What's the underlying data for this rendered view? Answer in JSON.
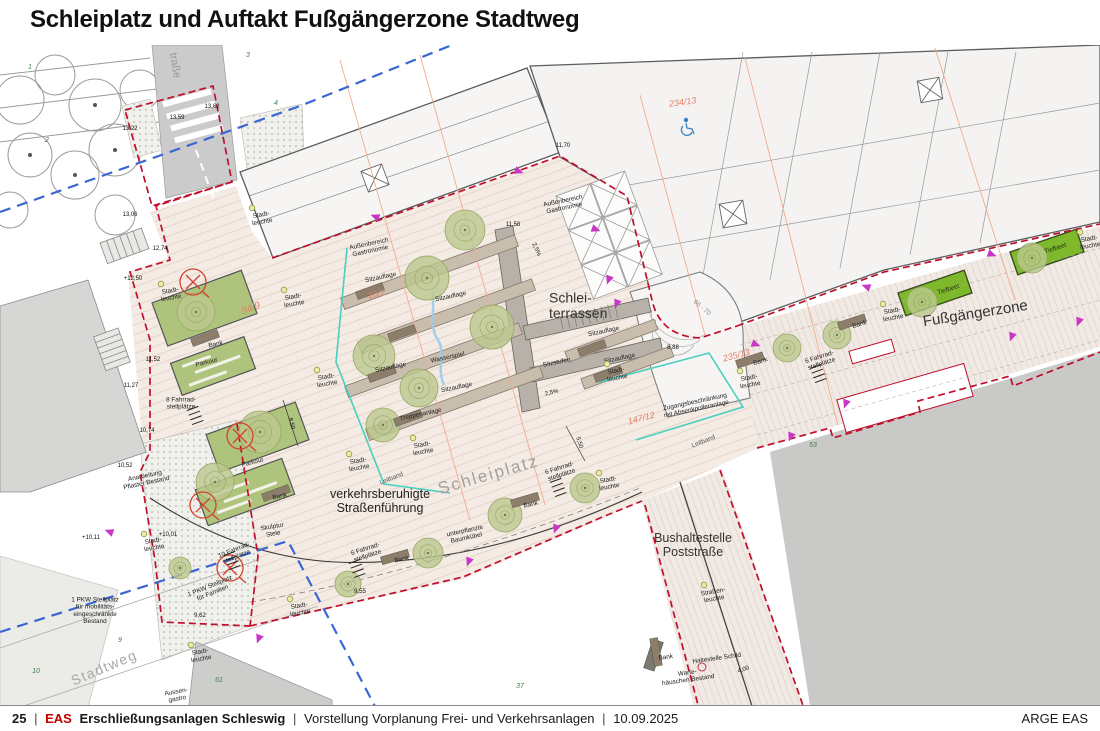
{
  "slide": {
    "title": "Schleiplatz und Auftakt Fußgängerzone Stadtweg",
    "footer": {
      "page": "25",
      "sep": "|",
      "brand": "EAS",
      "project": "Erschließungsanlagen Schleswig",
      "subtitle": "Vorstellung Vorplanung Frei- und Verkehrsanlagen",
      "date": "10.09.2025",
      "right": "ARGE EAS"
    }
  },
  "colors": {
    "paving": "#f3ebe4",
    "paving_stripe": "#e0cabb",
    "boundary_red": "#c00f2d",
    "line_blue": "#3a66d4",
    "line_cyan": "#49cfc0",
    "line_salmon": "#f2ab90",
    "tiefbeet_green": "#7db92a",
    "bed_green": "#aec47c",
    "tree_green": "#bcc88f",
    "bench_brown": "#8d7e6b",
    "existing_gray": "#c9c9c7",
    "parcel_red": "#e28266",
    "arrow_magenta": "#c738c7"
  },
  "plan": {
    "labels": [
      {
        "t": "Schlei-\nterrassen",
        "x": 549,
        "y": 310,
        "s": 14,
        "a": "start",
        "c": "#333"
      },
      {
        "t": "Fußgängerzone",
        "x": 976,
        "y": 318,
        "s": 15,
        "r": -9,
        "c": "#333"
      },
      {
        "t": "Schleiplatz",
        "x": 490,
        "y": 480,
        "s": 17,
        "r": -16,
        "c": "#a3a09d",
        "ls": 2
      },
      {
        "t": "verkehrsberuhigte\nStraßenführung",
        "x": 380,
        "y": 505,
        "s": 12.5,
        "c": "#222"
      },
      {
        "t": "Bushaltestelle\nPoststraße",
        "x": 693,
        "y": 549,
        "s": 12.5,
        "c": "#333"
      },
      {
        "t": "Stadtweg",
        "x": 106,
        "y": 672,
        "s": 14,
        "r": -23,
        "c": "#a8a8a8",
        "ls": 1.5
      },
      {
        "t": "traße",
        "x": 172,
        "y": 66,
        "s": 11,
        "r": 80,
        "c": "#9a9a9a"
      },
      {
        "t": "Außenbereich\nGastronomie",
        "x": 370,
        "y": 249,
        "r": -12
      },
      {
        "t": "Außenbereich\nGastronomie",
        "x": 564,
        "y": 206,
        "r": -12
      },
      {
        "t": "Sitzauflage",
        "x": 381,
        "y": 279,
        "r": -12
      },
      {
        "t": "Sitzauflage",
        "x": 451,
        "y": 298,
        "r": -12
      },
      {
        "t": "Sitzauflage",
        "x": 391,
        "y": 369,
        "r": -12
      },
      {
        "t": "Sitzauflage",
        "x": 457,
        "y": 389,
        "r": -12
      },
      {
        "t": "Sitzauflage",
        "x": 604,
        "y": 333,
        "r": -12
      },
      {
        "t": "Sitzauflage",
        "x": 620,
        "y": 360,
        "r": -12
      },
      {
        "t": "Wasserspiel",
        "x": 448,
        "y": 359,
        "r": -12
      },
      {
        "t": "Treppenanlage",
        "x": 421,
        "y": 416,
        "r": -12
      },
      {
        "t": "Sitzstufen",
        "x": 557,
        "y": 364,
        "r": -12
      },
      {
        "t": "Leitband",
        "x": 392,
        "y": 480,
        "r": -22,
        "c": "#555"
      },
      {
        "t": "Leitband",
        "x": 704,
        "y": 443,
        "r": -22,
        "c": "#555"
      },
      {
        "t": "Stadt-\nleuchte",
        "x": 171,
        "y": 296,
        "r": -10
      },
      {
        "t": "Stadt-\nleuchte",
        "x": 294,
        "y": 302,
        "r": -10
      },
      {
        "t": "Stadt-\nleuchte",
        "x": 327,
        "y": 382,
        "r": -10
      },
      {
        "t": "Stadt-\nleuchte",
        "x": 359,
        "y": 466,
        "r": -10
      },
      {
        "t": "Stadt-\nleuchte",
        "x": 423,
        "y": 450,
        "r": -10
      },
      {
        "t": "Stadt-\nleuchte",
        "x": 617,
        "y": 376,
        "r": -10
      },
      {
        "t": "Stadt-\nleuchte",
        "x": 609,
        "y": 485,
        "r": -10
      },
      {
        "t": "Stadt-\nleuchte",
        "x": 750,
        "y": 383,
        "r": -10
      },
      {
        "t": "Stadt-\nleuchte",
        "x": 893,
        "y": 316,
        "r": -10
      },
      {
        "t": "Stadt-\nleuchte",
        "x": 1090,
        "y": 244,
        "r": -10
      },
      {
        "t": "Stadt-\nleuchte",
        "x": 154,
        "y": 546,
        "r": -10
      },
      {
        "t": "Stadt-\nleuchte",
        "x": 201,
        "y": 657,
        "r": -10
      },
      {
        "t": "Stadt-\nleuchte",
        "x": 300,
        "y": 611,
        "r": -10
      },
      {
        "t": "Stadt-\nleuchte",
        "x": 262,
        "y": 220,
        "r": -10
      },
      {
        "t": "Straßen-\nleuchte",
        "x": 714,
        "y": 597,
        "r": -10
      },
      {
        "t": "Bank",
        "x": 216,
        "y": 346,
        "r": -12
      },
      {
        "t": "Bank",
        "x": 280,
        "y": 498,
        "r": -12
      },
      {
        "t": "Bank",
        "x": 531,
        "y": 506,
        "r": -12
      },
      {
        "t": "Bank",
        "x": 402,
        "y": 561,
        "r": -12
      },
      {
        "t": "Bank",
        "x": 860,
        "y": 326,
        "r": -18
      },
      {
        "t": "Bank",
        "x": 761,
        "y": 363,
        "r": -18
      },
      {
        "t": "Bank",
        "x": 666,
        "y": 659,
        "r": -8
      },
      {
        "t": "Parkour",
        "x": 207,
        "y": 364,
        "r": -14
      },
      {
        "t": "Parkour",
        "x": 253,
        "y": 464,
        "r": -14
      },
      {
        "t": "8 Fahrrad-\nstellplätze",
        "x": 181,
        "y": 405
      },
      {
        "t": "10 Fahrrad-\nstellplätze",
        "x": 236,
        "y": 555,
        "r": -22
      },
      {
        "t": "6 Fahrrad-\nstellplätze",
        "x": 561,
        "y": 473,
        "r": -18
      },
      {
        "t": "6 Fahrrad-\nstellplätze",
        "x": 367,
        "y": 554,
        "r": -18
      },
      {
        "t": "6 Fahrrad-\nstellplätze",
        "x": 821,
        "y": 362,
        "r": -18
      },
      {
        "t": "Tiefbeet",
        "x": 949,
        "y": 291,
        "r": -18,
        "c": "#1d2d10"
      },
      {
        "t": "Tiefbeet",
        "x": 1056,
        "y": 250,
        "r": -18,
        "c": "#1d2d10"
      },
      {
        "t": "unterpflanzte\nBaumkübel",
        "x": 466,
        "y": 536,
        "r": -12
      },
      {
        "t": "Zugangsbeschränkung\nmit Absenkpolleranlage",
        "x": 696,
        "y": 407,
        "r": -12
      },
      {
        "t": "Anarbeitung\nPflaster Bestand",
        "x": 146,
        "y": 481,
        "r": -12
      },
      {
        "t": "1 PKW Stellplatz\nfür mobilitäts-\neingeschränkte\nBestand",
        "x": 95,
        "y": 612
      },
      {
        "t": "1 PKW Stellplatz\nfür Familien",
        "x": 212,
        "y": 591,
        "r": -22
      },
      {
        "t": "Skulptur\nStele",
        "x": 273,
        "y": 532,
        "r": -10
      },
      {
        "t": "Haltestelle Schild",
        "x": 717,
        "y": 660,
        "r": -8
      },
      {
        "t": "Warte-\nhäuschen Bestand",
        "x": 688,
        "y": 678,
        "r": -8
      },
      {
        "t": "Aussen-\ngastro",
        "x": 177,
        "y": 697,
        "r": -10
      },
      {
        "t": "234/13",
        "x": 683,
        "y": 105,
        "s": 9,
        "r": -8,
        "c": "#e28266",
        "i": true
      },
      {
        "t": "94/9",
        "x": 252,
        "y": 311,
        "s": 10,
        "r": -22,
        "c": "#e28266",
        "i": true
      },
      {
        "t": "10/2",
        "x": 377,
        "y": 297,
        "s": 9,
        "r": -12,
        "c": "#e28266",
        "i": true
      },
      {
        "t": "147/12",
        "x": 642,
        "y": 421,
        "s": 9,
        "r": -15,
        "c": "#e28266",
        "i": true
      },
      {
        "t": "235/13",
        "x": 737,
        "y": 358,
        "s": 9,
        "r": -15,
        "c": "#e28266",
        "i": true
      },
      {
        "t": "66 - 70",
        "x": 701,
        "y": 309,
        "s": 6.5,
        "r": 40,
        "c": "#8a8a8a"
      },
      {
        "t": "13,62",
        "x": 212,
        "y": 108,
        "s": 6,
        "c": "#111"
      },
      {
        "t": "13,59",
        "x": 177,
        "y": 119,
        "s": 6,
        "c": "#111"
      },
      {
        "t": "13,22",
        "x": 130,
        "y": 130,
        "s": 6,
        "c": "#111"
      },
      {
        "t": "13,06",
        "x": 130,
        "y": 216,
        "s": 6,
        "c": "#111"
      },
      {
        "t": "12,74",
        "x": 160,
        "y": 250,
        "s": 6,
        "c": "#111"
      },
      {
        "t": "+12,50",
        "x": 133,
        "y": 280,
        "s": 6,
        "c": "#111"
      },
      {
        "t": "11,70",
        "x": 563,
        "y": 147,
        "s": 6,
        "c": "#111"
      },
      {
        "t": "11,58",
        "x": 513,
        "y": 226,
        "s": 6,
        "c": "#111"
      },
      {
        "t": "11,52",
        "x": 153,
        "y": 361,
        "s": 6,
        "c": "#111"
      },
      {
        "t": "11,27",
        "x": 131,
        "y": 387,
        "s": 6,
        "c": "#111"
      },
      {
        "t": "10,74",
        "x": 147,
        "y": 432,
        "s": 6,
        "c": "#111"
      },
      {
        "t": "10,52",
        "x": 125,
        "y": 467,
        "s": 6,
        "c": "#111"
      },
      {
        "t": "+10,11",
        "x": 91,
        "y": 539,
        "s": 6,
        "c": "#111"
      },
      {
        "t": "+10,01",
        "x": 168,
        "y": 536,
        "s": 6,
        "c": "#111"
      },
      {
        "t": "9,62",
        "x": 200,
        "y": 617,
        "s": 6,
        "c": "#111"
      },
      {
        "t": "9,55",
        "x": 360,
        "y": 593,
        "s": 6,
        "c": "#111"
      },
      {
        "t": "8,88",
        "x": 673,
        "y": 349,
        "s": 6,
        "c": "#111"
      },
      {
        "t": "8,50",
        "x": 290,
        "y": 424,
        "s": 6,
        "r": 75,
        "c": "#111"
      },
      {
        "t": "5,50",
        "x": 578,
        "y": 443,
        "s": 6,
        "r": 72,
        "c": "#111"
      },
      {
        "t": "4,00",
        "x": 744,
        "y": 671,
        "s": 6,
        "r": -20,
        "c": "#111"
      },
      {
        "t": "2,5%",
        "x": 535,
        "y": 250,
        "s": 6,
        "r": 65,
        "c": "#111"
      },
      {
        "t": "2,5%",
        "x": 552,
        "y": 394,
        "s": 6,
        "r": -14,
        "c": "#111"
      },
      {
        "t": "1",
        "x": 30,
        "y": 69,
        "s": 7,
        "c": "#3f7d46",
        "i": true
      },
      {
        "t": "2",
        "x": 47,
        "y": 142,
        "s": 7,
        "c": "#3f7d46",
        "i": true
      },
      {
        "t": "3",
        "x": 248,
        "y": 57,
        "s": 7,
        "c": "#3f7d46",
        "i": true
      },
      {
        "t": "4",
        "x": 276,
        "y": 105,
        "s": 7,
        "c": "#3f7d46",
        "i": true
      },
      {
        "t": "9",
        "x": 120,
        "y": 642,
        "s": 7,
        "c": "#3f7d46",
        "i": true
      },
      {
        "t": "10",
        "x": 36,
        "y": 673,
        "s": 7,
        "c": "#3f7d46",
        "i": true
      },
      {
        "t": "37",
        "x": 520,
        "y": 688,
        "s": 7,
        "c": "#3f7d46",
        "i": true
      },
      {
        "t": "53",
        "x": 813,
        "y": 447,
        "s": 7,
        "c": "#3f7d46",
        "i": true
      },
      {
        "t": "61",
        "x": 219,
        "y": 682,
        "s": 7,
        "c": "#3f7d46",
        "i": true
      }
    ],
    "symbols": {
      "trees": [
        [
          465,
          230,
          20
        ],
        [
          427,
          278,
          22
        ],
        [
          492,
          327,
          22
        ],
        [
          374,
          356,
          21
        ],
        [
          419,
          388,
          19
        ],
        [
          383,
          425,
          17
        ],
        [
          505,
          515,
          17
        ],
        [
          585,
          488,
          15
        ],
        [
          428,
          553,
          15
        ],
        [
          348,
          584,
          13
        ],
        [
          180,
          568,
          11
        ],
        [
          787,
          348,
          14
        ],
        [
          837,
          335,
          14
        ],
        [
          922,
          302,
          15
        ],
        [
          1032,
          258,
          15
        ],
        [
          196,
          312,
          19
        ],
        [
          260,
          432,
          21
        ],
        [
          215,
          482,
          19
        ]
      ],
      "benches": [
        [
          205,
          338,
          -20
        ],
        [
          276,
          493,
          -20
        ],
        [
          525,
          500,
          -16
        ],
        [
          395,
          557,
          -16
        ],
        [
          852,
          322,
          -18
        ],
        [
          750,
          360,
          -18
        ],
        [
          656,
          652,
          80
        ],
        [
          370,
          291,
          -20
        ],
        [
          402,
          333,
          -20
        ],
        [
          382,
          374,
          -20
        ],
        [
          408,
          418,
          -20
        ],
        [
          592,
          348,
          -20
        ],
        [
          608,
          374,
          -20
        ]
      ],
      "arrows": [
        [
          379,
          218,
          200
        ],
        [
          592,
          228,
          20
        ],
        [
          610,
          276,
          110
        ],
        [
          618,
          300,
          110
        ],
        [
          870,
          288,
          200
        ],
        [
          988,
          253,
          20
        ],
        [
          1080,
          318,
          110
        ],
        [
          1013,
          333,
          110
        ],
        [
          752,
          343,
          20
        ],
        [
          847,
          400,
          110
        ],
        [
          792,
          433,
          110
        ],
        [
          557,
          525,
          110
        ],
        [
          470,
          558,
          110
        ],
        [
          260,
          635,
          110
        ],
        [
          113,
          533,
          200
        ],
        [
          515,
          170,
          20
        ]
      ],
      "fell_circles": [
        [
          193,
          282
        ],
        [
          240,
          436
        ],
        [
          203,
          505
        ],
        [
          230,
          568
        ]
      ],
      "bike_racks": [
        [
          558,
          487
        ],
        [
          357,
          568
        ],
        [
          818,
          373
        ],
        [
          232,
          560
        ],
        [
          195,
          415
        ]
      ]
    }
  }
}
